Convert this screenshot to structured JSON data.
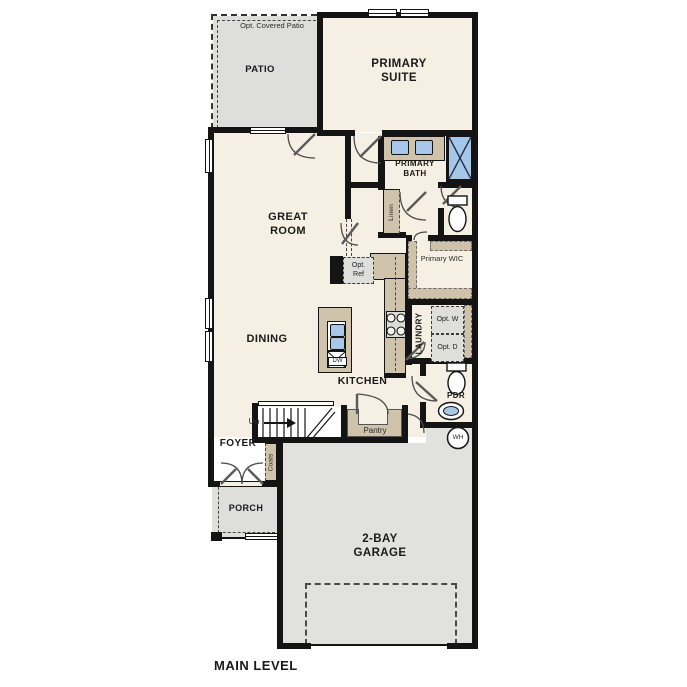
{
  "title": "MAIN LEVEL",
  "rooms": {
    "patio": {
      "label": "PATIO",
      "note": "Opt. Covered Patio"
    },
    "primary_suite": {
      "label": "PRIMARY SUITE"
    },
    "primary_bath": {
      "label": "PRIMARY BATH"
    },
    "linen": {
      "label": "Linen"
    },
    "primary_wic": {
      "label": "Primary WIC"
    },
    "great_room": {
      "label": "GREAT ROOM"
    },
    "dining": {
      "label": "DINING"
    },
    "kitchen": {
      "label": "KITCHEN"
    },
    "laundry": {
      "label": "LAUNDRY"
    },
    "pdr": {
      "label": "PDR"
    },
    "foyer": {
      "label": "FOYER"
    },
    "coats": {
      "label": "Coats"
    },
    "pantry": {
      "label": "Pantry"
    },
    "porch": {
      "label": "PORCH"
    },
    "garage": {
      "label": "2-BAY GARAGE"
    }
  },
  "fixtures": {
    "opt_ref": "Opt. Ref",
    "opt_washer": "Opt. W",
    "opt_dryer": "Opt. D",
    "dishwasher": "DW",
    "water_heater": "WH",
    "stairs_up": "Up"
  },
  "colors": {
    "floor": "#f6efe3",
    "outdoor": "#e1e1df",
    "cabinet": "#d0c3ab",
    "fixture_blue": "#a9c8e9",
    "wall": "#141414"
  }
}
